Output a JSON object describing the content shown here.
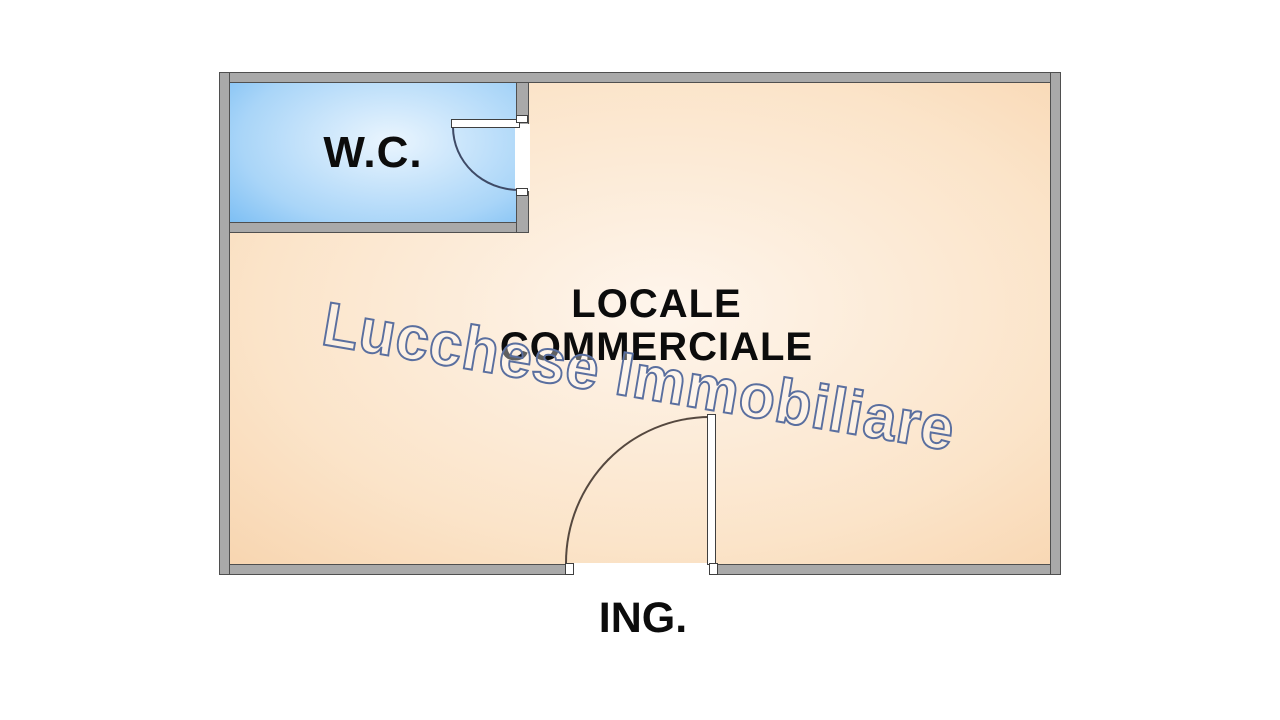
{
  "floor_plan": {
    "rooms": {
      "wc": {
        "label": "W.C."
      },
      "main": {
        "label": "LOCALE COMMERCIALE"
      }
    },
    "entrance": {
      "label": "ING."
    },
    "watermark": {
      "text": "Lucchese Immobiliare"
    },
    "colors": {
      "background": "#ffffff",
      "wall_fill": "#a9a9a9",
      "wall_outline": "#4f4f4f",
      "wc_fill_center": "#eaf5fe",
      "wc_fill_edge": "#58acf0",
      "main_fill_center": "#fef5ec",
      "main_fill_edge": "#f6cda2",
      "label_text": "#0c0c0c",
      "watermark_outline": "#5a6f9f"
    }
  }
}
